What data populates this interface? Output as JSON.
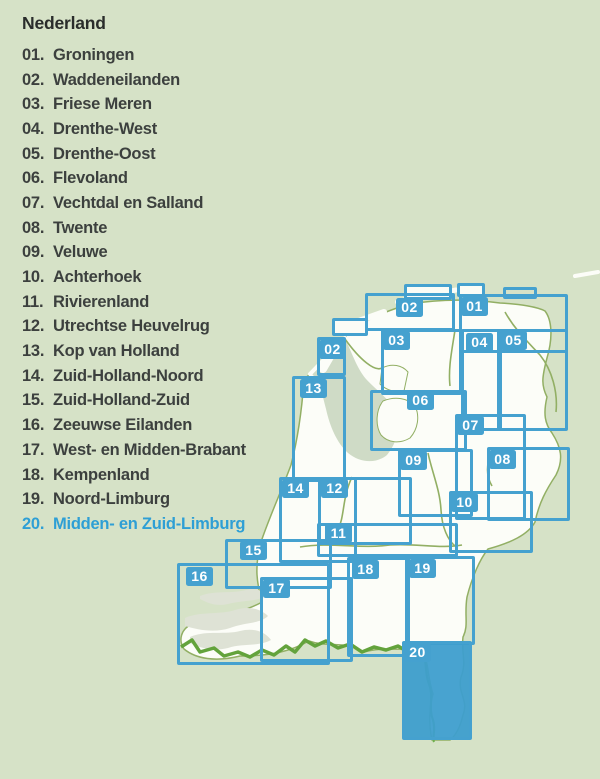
{
  "legend": {
    "title": "Nederland",
    "items": [
      {
        "num": "01.",
        "name": "Groningen",
        "highlight": false
      },
      {
        "num": "02.",
        "name": "Waddeneilanden",
        "highlight": false
      },
      {
        "num": "03.",
        "name": "Friese Meren",
        "highlight": false
      },
      {
        "num": "04.",
        "name": "Drenthe-West",
        "highlight": false
      },
      {
        "num": "05.",
        "name": "Drenthe-Oost",
        "highlight": false
      },
      {
        "num": "06.",
        "name": "Flevoland",
        "highlight": false
      },
      {
        "num": "07.",
        "name": "Vechtdal en Salland",
        "highlight": false
      },
      {
        "num": "08.",
        "name": "Twente",
        "highlight": false
      },
      {
        "num": "09.",
        "name": "Veluwe",
        "highlight": false
      },
      {
        "num": "10.",
        "name": "Achterhoek",
        "highlight": false
      },
      {
        "num": "11.",
        "name": "Rivierenland",
        "highlight": false
      },
      {
        "num": "12.",
        "name": "Utrechtse Heuvelrug",
        "highlight": false
      },
      {
        "num": "13.",
        "name": "Kop van Holland",
        "highlight": false
      },
      {
        "num": "14.",
        "name": "Zuid-Holland-Noord",
        "highlight": false
      },
      {
        "num": "15.",
        "name": "Zuid-Holland-Zuid",
        "highlight": false
      },
      {
        "num": "16.",
        "name": "Zeeuwse Eilanden",
        "highlight": false
      },
      {
        "num": "17.",
        "name": "West- en Midden-Brabant",
        "highlight": false
      },
      {
        "num": "18.",
        "name": "Kempenland",
        "highlight": false
      },
      {
        "num": "19.",
        "name": "Noord-Limburg",
        "highlight": false
      },
      {
        "num": "20.",
        "name": "Midden- en Zuid-Limburg",
        "highlight": true
      }
    ]
  },
  "colors": {
    "background": "#d6e2c7",
    "land": "#fcfdf8",
    "sheet_blue": "#45a1cf",
    "highlight_text": "#2e9fd5",
    "list_text": "#3c403e",
    "border_green": "#63a33c",
    "line_olive": "#92af64",
    "lake": "#cfdbc6",
    "zeeland_gray": "#dee2d5"
  },
  "map": {
    "sheets": [
      {
        "id": "01-cap",
        "label": "",
        "x": 457,
        "y": 283,
        "w": 28,
        "h": 14,
        "fill": "land"
      },
      {
        "id": "01-bump",
        "label": "",
        "x": 503,
        "y": 287,
        "w": 34,
        "h": 12
      },
      {
        "id": "02-west-cap",
        "label": "",
        "x": 332,
        "y": 318,
        "w": 36,
        "h": 18,
        "fill": "land"
      },
      {
        "id": "02-east-cap",
        "label": "",
        "x": 404,
        "y": 284,
        "w": 48,
        "h": 16,
        "fill": "land"
      },
      {
        "id": "02-east",
        "label": "02",
        "x": 365,
        "y": 293,
        "w": 90,
        "h": 38,
        "lx": 396,
        "ly": 298
      },
      {
        "id": "01",
        "label": "01",
        "x": 459,
        "y": 294,
        "w": 109,
        "h": 59,
        "lx": 461,
        "ly": 297
      },
      {
        "id": "03",
        "label": "03",
        "x": 381,
        "y": 329,
        "w": 81,
        "h": 66,
        "lx": 383,
        "ly": 331
      },
      {
        "id": "02-west",
        "label": "02",
        "x": 317,
        "y": 337,
        "w": 29,
        "h": 39,
        "lx": 319,
        "ly": 340
      },
      {
        "id": "04",
        "label": "04",
        "x": 461,
        "y": 329,
        "w": 41,
        "h": 102,
        "lx": 466,
        "ly": 333
      },
      {
        "id": "05",
        "label": "05",
        "x": 497,
        "y": 329,
        "w": 71,
        "h": 102,
        "lx": 500,
        "ly": 331
      },
      {
        "id": "13",
        "label": "13",
        "x": 292,
        "y": 376,
        "w": 54,
        "h": 106,
        "lx": 300,
        "ly": 379
      },
      {
        "id": "06",
        "label": "06",
        "x": 370,
        "y": 390,
        "w": 97,
        "h": 61,
        "lx": 407,
        "ly": 391
      },
      {
        "id": "07",
        "label": "07",
        "x": 455,
        "y": 414,
        "w": 71,
        "h": 106,
        "lx": 457,
        "ly": 416
      },
      {
        "id": "08",
        "label": "08",
        "x": 487,
        "y": 447,
        "w": 83,
        "h": 74,
        "lx": 489,
        "ly": 450
      },
      {
        "id": "09",
        "label": "09",
        "x": 398,
        "y": 449,
        "w": 75,
        "h": 68,
        "lx": 400,
        "ly": 451
      },
      {
        "id": "12",
        "label": "12",
        "x": 318,
        "y": 477,
        "w": 94,
        "h": 68,
        "lx": 321,
        "ly": 479
      },
      {
        "id": "14",
        "label": "14",
        "x": 279,
        "y": 477,
        "w": 78,
        "h": 86,
        "lx": 282,
        "ly": 479
      },
      {
        "id": "10",
        "label": "10",
        "x": 449,
        "y": 491,
        "w": 84,
        "h": 62,
        "lx": 451,
        "ly": 493
      },
      {
        "id": "11",
        "label": "11",
        "x": 317,
        "y": 523,
        "w": 141,
        "h": 34,
        "lx": 325,
        "ly": 524
      },
      {
        "id": "15",
        "label": "15",
        "x": 225,
        "y": 539,
        "w": 107,
        "h": 50,
        "lx": 240,
        "ly": 541
      },
      {
        "id": "16",
        "label": "16",
        "x": 177,
        "y": 563,
        "w": 153,
        "h": 102,
        "lx": 186,
        "ly": 567
      },
      {
        "id": "17",
        "label": "17",
        "x": 260,
        "y": 577,
        "w": 93,
        "h": 85,
        "lx": 263,
        "ly": 579
      },
      {
        "id": "18",
        "label": "18",
        "x": 347,
        "y": 557,
        "w": 63,
        "h": 100,
        "lx": 352,
        "ly": 560
      },
      {
        "id": "19",
        "label": "19",
        "x": 405,
        "y": 556,
        "w": 70,
        "h": 89,
        "lx": 409,
        "ly": 559
      },
      {
        "id": "20",
        "label": "20",
        "x": 402,
        "y": 641,
        "w": 70,
        "h": 99,
        "lx": 404,
        "ly": 643,
        "filled": true
      }
    ]
  }
}
